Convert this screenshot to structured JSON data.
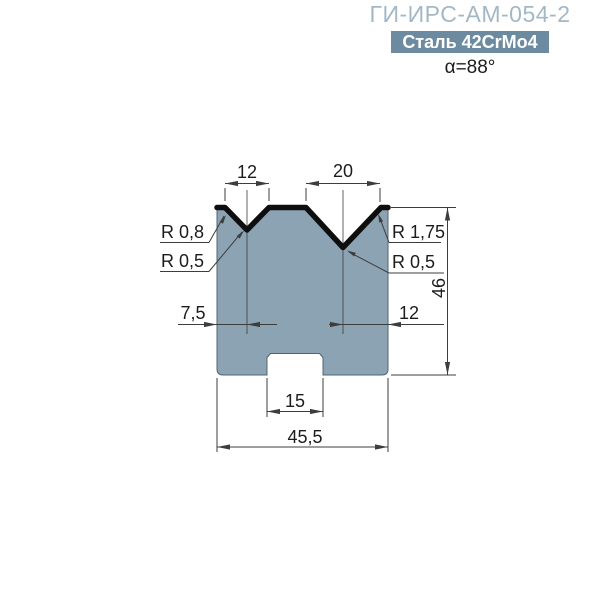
{
  "header": {
    "title": "ГИ-ИРС-АМ-054-2",
    "material_badge": "Сталь 42CrMo4",
    "angle": "α=88°"
  },
  "drawing": {
    "description": "Cross-section of a two-V press brake lower die",
    "dims": {
      "v1_opening": "12",
      "v2_opening": "20",
      "v1_center_from_left_edge": "7,5",
      "v2_center_from_right_edge": "12",
      "overall_height": "46",
      "slot_width": "15",
      "overall_width": "45,5"
    },
    "radii": {
      "left_shoulder": "R 0,8",
      "left_groove": "R 0,5",
      "right_shoulder": "R 1,75",
      "right_groove": "R 0,5"
    }
  },
  "colors": {
    "title": "#a3b8c7",
    "badge_bg": "#6d8ba0",
    "badge_text": "#ffffff",
    "die_fill": "#8ba3b3",
    "die_edge": "#53646e",
    "profile": "#0e0e0e",
    "dimline": "#3d3d3d",
    "dimtext": "#1c1c1c",
    "bg": "#ffffff"
  }
}
